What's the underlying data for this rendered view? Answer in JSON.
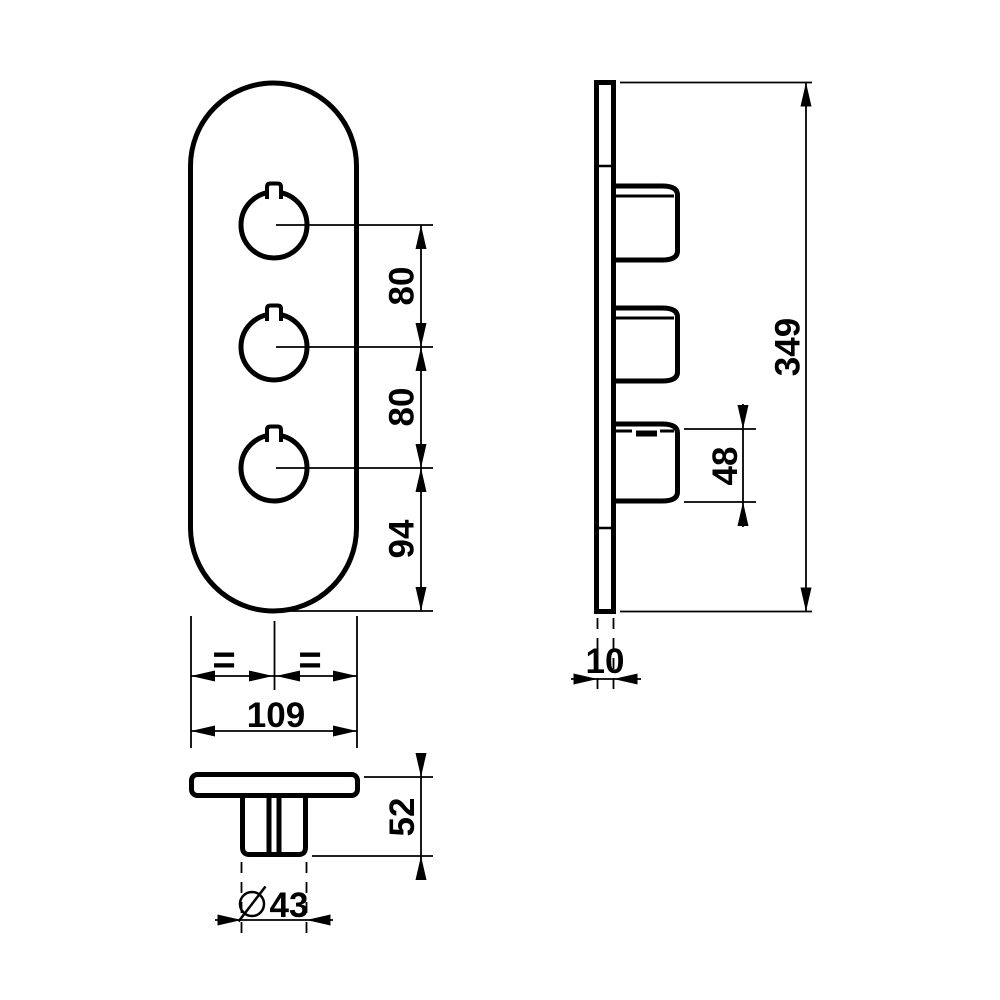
{
  "colors": {
    "ink": "#000000",
    "paper": "#ffffff"
  },
  "front_view": {
    "dim_knob_spacing_top": "80",
    "dim_knob_spacing_bottom": "80",
    "dim_bottom_offset": "94",
    "equal_left": "=",
    "equal_right": "=",
    "dim_plate_width": "109"
  },
  "side_view": {
    "dim_plate_height": "349",
    "dim_knob_size": "48",
    "dim_plate_thickness": "10"
  },
  "bottom_view": {
    "dim_knob_projection": "52",
    "dim_knob_diameter": "43"
  }
}
